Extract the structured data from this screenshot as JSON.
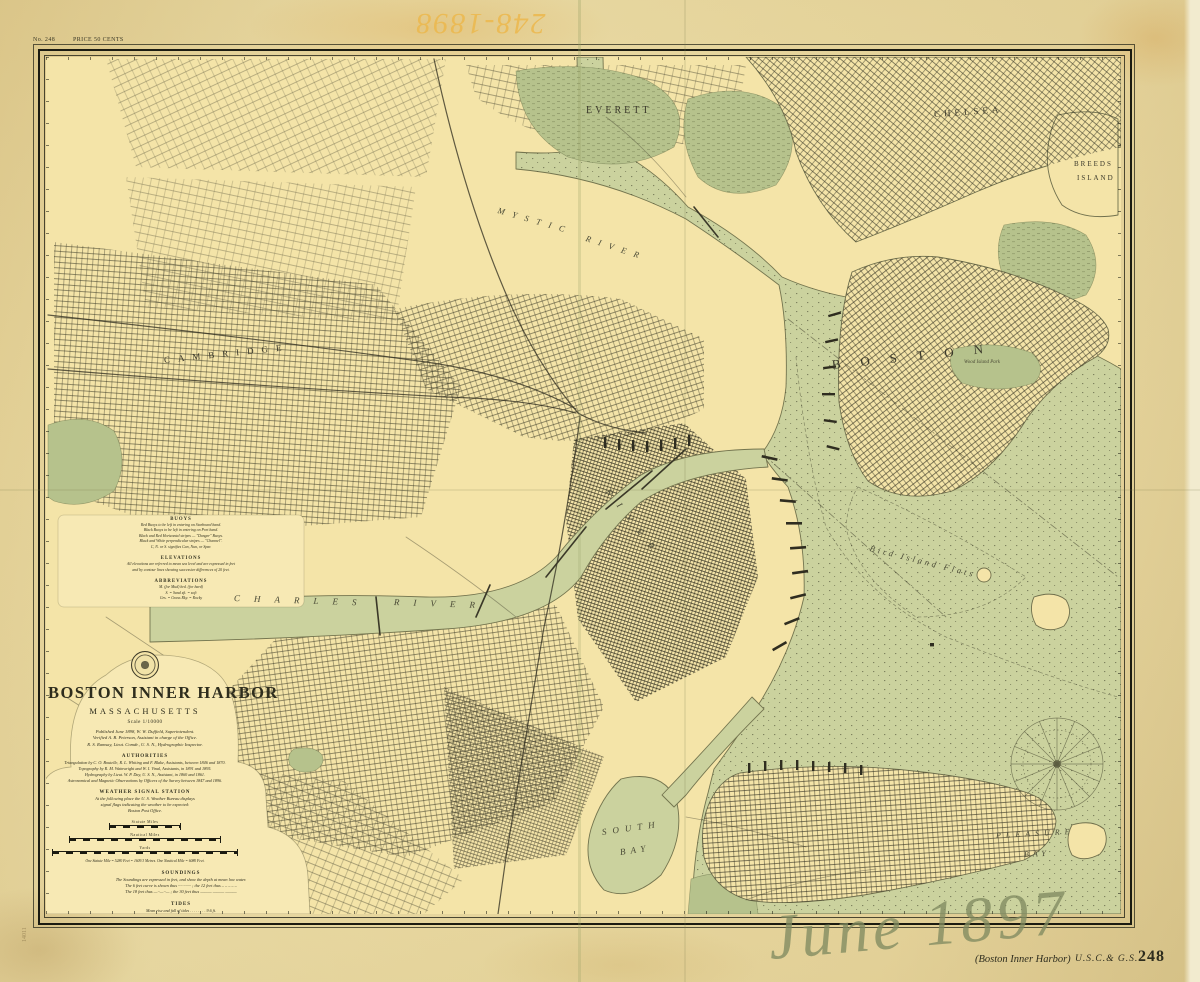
{
  "sheet": {
    "plate_note_left": "No. 248",
    "plate_note_right": "PRICE 50 CENTS",
    "handwriting_top": "248-1898",
    "handwriting_bottom": "June 1897",
    "archive_mark": "14011",
    "footer": {
      "title_note": "(Boston Inner Harbor)",
      "agency": "U.S.C.& G.S.",
      "number": "248"
    }
  },
  "colors": {
    "paper": "#ead9a0",
    "land": "#f4e4a8",
    "water": "#cbd29e",
    "marsh": "#b6c28c",
    "ink": "#2e2d1d",
    "handwriting_orange": "#ecb94f",
    "pencil": "#8e9877"
  },
  "cartouche": {
    "title": "BOSTON INNER HARBOR",
    "subtitle": "MASSACHUSETTS",
    "scale_note": "Scale 1/10000",
    "publication_lines": [
      "Published June 1898, W. W. Duffield, Superintendent.",
      "Verified A. B. Peterson, Assistant in charge of the Office.",
      "R. S. Ramsay, Lieut. Comdr., U. S. N., Hydrographic Inspector."
    ],
    "authorities_heading": "AUTHORITIES",
    "authorities_lines": [
      "Triangulation by C. O. Boutelle, R. L. Whiting and F. Blake, Assistants, between 1846 and 1870.",
      "Topography by R. M. Wainwright and W. I. Vinal, Assistants, in 1891 and 1895.",
      "Hydrography by Lieut. W. P. Day, U. S. N., Assistant, in 1860 and 1861.",
      "Astronomical and Magnetic Observations by Officers of the Survey between 1847 and 1896."
    ],
    "weather_heading": "WEATHER SIGNAL STATION",
    "weather_lines": [
      "At the following place the U. S. Weather Bureau displays",
      "signal flags indicating the weather to be expected:",
      "Boston Post Office."
    ],
    "scale_bars": [
      "Statute Miles",
      "Nautical Miles",
      "Yards"
    ],
    "scale_footnote": "One Statute Mile = 5280 Feet = 1609.3 Metres.   One Nautical Mile = 6080 Feet.",
    "soundings_heading": "SOUNDINGS",
    "soundings_lines": [
      "The Soundings are expressed in feet, and show the depth at mean low water.",
      "The 6 feet curve is shown thus ∙∙∙∙∙∙∙∙∙∙∙∙ ;  the 12 feet thus – – – – –",
      "The 18 feet thus —∙∙—∙∙— ;  the 30 feet thus ——— ——— ———"
    ],
    "tides_heading": "TIDES",
    "tides_lines": [
      "Mean rise and fall of tides . . . . . . . . 9.6 ft.",
      "Mean duration of rise . . . 6h 11m      of fall . . . 6h 14m",
      "Average rise and fall of Spring tides . . . . 11.0 ft.",
      "Average rise and fall of Neap tides . . . . . 8.4 ft.",
      "The predicted times and heights of the tide are given in the TIDE",
      "TABLES published annually by the U. S. Coast and Geodetic Survey."
    ]
  },
  "notes": {
    "buoys_heading": "BUOYS",
    "buoys_lines": [
      "Red Buoys to be left in entering on Starboard hand.",
      "Black Buoys to be left in entering on Port hand.",
      "Black and Red Horizontal stripes — \"Danger\" Buoys.",
      "Black and White perpendicular stripes — \"Channel\".",
      "C, N. or S. signifies Can, Nun, or Spar."
    ],
    "elevations_heading": "ELEVATIONS",
    "elevations_lines": [
      "All elevations are referred to mean sea level and are expressed in feet",
      "and by contour lines showing successive differences of 20 feet."
    ],
    "abbreviations_heading": "ABBREVIATIONS",
    "abbreviations_lines": [
      "M. (for Mud)    hrd. (for hard)",
      "S.  =  Sand       sft.  =  soft",
      "Grs. = Grass      Rky. = Rocky"
    ]
  },
  "map_labels": [
    {
      "text": "EVERETT",
      "x": 540,
      "y": 48,
      "size": 10,
      "ls": 3
    },
    {
      "text": "CHELSEA",
      "x": 888,
      "y": 52,
      "size": 9,
      "ls": 4,
      "rot": -4
    },
    {
      "text": "BREEDS",
      "x": 1028,
      "y": 103,
      "size": 7,
      "ls": 2
    },
    {
      "text": "ISLAND",
      "x": 1031,
      "y": 117,
      "size": 7,
      "ls": 2
    },
    {
      "text": "BOSTON",
      "x": 786,
      "y": 300,
      "size": 13,
      "ls": 20,
      "rot": -6
    },
    {
      "text": "Wood Island Park",
      "x": 918,
      "y": 303,
      "size": 5,
      "italic": true
    },
    {
      "text": "Bird Island Flats",
      "x": 824,
      "y": 486,
      "size": 8.5,
      "ls": 3,
      "rot": 14,
      "italic": true
    },
    {
      "text": "MYSTIC",
      "x": 452,
      "y": 148,
      "size": 8.5,
      "ls": 8,
      "rot": 16,
      "italic": true
    },
    {
      "text": "RIVER",
      "x": 540,
      "y": 176,
      "size": 8.5,
      "ls": 8,
      "rot": 18,
      "italic": true
    },
    {
      "text": "CHARLES",
      "x": 188,
      "y": 536,
      "size": 9,
      "ls": 14,
      "rot": 2,
      "italic": true
    },
    {
      "text": "RIVER",
      "x": 348,
      "y": 540,
      "size": 9,
      "ls": 14,
      "rot": 2,
      "italic": true
    },
    {
      "text": "RIVER",
      "x": 562,
      "y": 428,
      "size": 9,
      "ls": 12,
      "rot": 52,
      "italic": true
    },
    {
      "text": "CAMBRIDGE",
      "x": 118,
      "y": 298,
      "size": 9,
      "ls": 8,
      "rot": -6
    },
    {
      "text": "SOUTH",
      "x": 556,
      "y": 770,
      "size": 9,
      "ls": 6,
      "rot": -8,
      "italic": true
    },
    {
      "text": "BAY",
      "x": 574,
      "y": 790,
      "size": 9,
      "ls": 5,
      "rot": -8,
      "italic": true
    },
    {
      "text": "PLEASURE",
      "x": 950,
      "y": 774,
      "size": 8,
      "ls": 5,
      "rot": -3,
      "italic": true
    },
    {
      "text": "BAY",
      "x": 978,
      "y": 793,
      "size": 8,
      "ls": 4,
      "rot": -3,
      "italic": true
    }
  ]
}
